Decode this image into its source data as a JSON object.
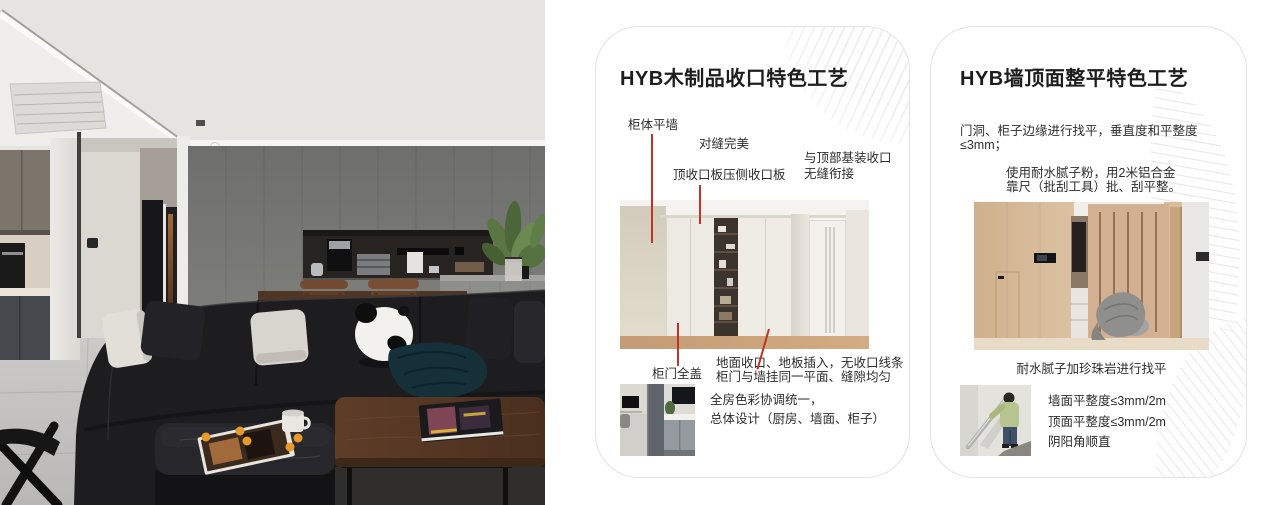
{
  "colors": {
    "annotation_line": "#c0322a",
    "card_border": "#e3e3e3",
    "accent_red": "#c0322a"
  },
  "cards": {
    "woodwork": {
      "title": "HYB木制品收口特色工艺",
      "annotations": {
        "cabinet_flush_wall": "柜体平墙",
        "perfect_seam": "对缝完美",
        "top_panel": "顶收口板压侧收口板",
        "ceiling_join_line1": "与顶部基装收口",
        "ceiling_join_line2": "无缝衔接",
        "full_cover_door": "柜门全盖",
        "floor_join_line1": "地面收口、地板插入，无收口线条",
        "floor_join_line2": "柜门与墙挂同一平面、缝隙均匀",
        "color_line1": "全房色彩协调统一，",
        "color_line2": "总体设计（厨房、墙面、柜子）"
      }
    },
    "leveling": {
      "title": "HYB墙顶面整平特色工艺",
      "para1": "门洞、柜子边缘进行找平，垂直度和平整度≤3mm；",
      "para2_line1": "使用耐水腻子粉，用2米铝合金",
      "para2_line2": "靠尺（批刮工具）批、刮平整。",
      "caption": "耐水腻子加珍珠岩进行找平",
      "bullets": [
        "墙面平整度≤3mm/2m",
        "顶面平整度≤3mm/2m",
        "阴阳角顺直"
      ]
    }
  }
}
